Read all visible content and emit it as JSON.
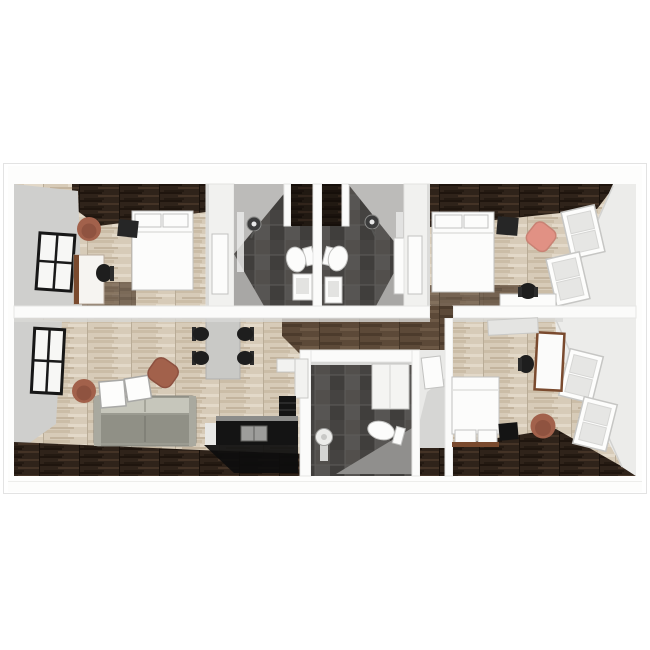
{
  "meta": {
    "kind": "3d-floor-plan-render",
    "view": "top-down dollhouse cutaway",
    "text_visible": false
  },
  "palette": {
    "canvas": "#ffffff",
    "frameBorder": "#e3e3e3",
    "wallWhite": "#fbfbfa",
    "wallEdge": "#e6e6e4",
    "wallFaceGray": "#cfcfcd",
    "wallFaceLight": "#ececea",
    "fixtureWhite": "#fcfcfb",
    "fixtureStroke": "#c2c2c0",
    "woodLight": "#d7cbb8",
    "woodMid": "#5c4938",
    "woodDark": "#2f231a",
    "tileDark": "#4d4b49",
    "sofaGray": "#9b9b91",
    "tableGray": "#c9c9c6",
    "chairBlack": "#1e1e1e",
    "applianceBlack": "#141414",
    "accentClay": "#a2614b",
    "accentPink": "#e19184",
    "deskWood": "#7a4a2e",
    "glassGray": "#e6e6e4",
    "windowBlack": "#171717"
  },
  "scene": {
    "rooms": [
      {
        "name": "bedroom-top-left",
        "floor": "light-wood",
        "accent": "dark-wood-band",
        "furniture": [
          "double-bed",
          "tv-stand",
          "round-armchair",
          "desk",
          "desk-chair",
          "window"
        ]
      },
      {
        "name": "bathroom-left",
        "floor": "dark-tile",
        "furniture": [
          "shower-head",
          "glass-panel",
          "toilet",
          "vanity-sink",
          "closet-niche",
          "door-leaf"
        ]
      },
      {
        "name": "bathroom-right",
        "floor": "dark-tile",
        "furniture": [
          "shower-head",
          "glass-panel",
          "toilet",
          "vanity-sink",
          "closet-niche",
          "door-leaf"
        ]
      },
      {
        "name": "bedroom-top-right",
        "floor": "light-wood",
        "accent": "dark-wood-band",
        "furniture": [
          "double-bed",
          "tv-stand",
          "lounge-chair",
          "desk",
          "desk-chair",
          "window",
          "window"
        ]
      },
      {
        "name": "living-kitchen",
        "floor": "light-wood",
        "accent": "dark-wood-band",
        "furniture": [
          "sofa",
          "coffee-table",
          "coffee-table",
          "pouf",
          "round-armchair",
          "dining-table",
          "dining-chair",
          "dining-chair",
          "dining-chair",
          "dining-chair",
          "kitchen-counter",
          "kitchen-sink",
          "tall-cabinet",
          "window"
        ]
      },
      {
        "name": "bathroom-bottom",
        "floor": "dark-tile",
        "furniture": [
          "toilet",
          "pedestal-sink",
          "tall-cabinet"
        ]
      },
      {
        "name": "hall-closet",
        "floor": "dark-wood",
        "furniture": [
          "door-leaf"
        ]
      },
      {
        "name": "bedroom-bottom-right",
        "floor": "light-wood",
        "accent": "dark-wood-band",
        "furniture": [
          "double-bed",
          "tv-stand",
          "round-armchair",
          "desk",
          "desk-chair",
          "window",
          "window",
          "door-leaf"
        ]
      }
    ]
  }
}
